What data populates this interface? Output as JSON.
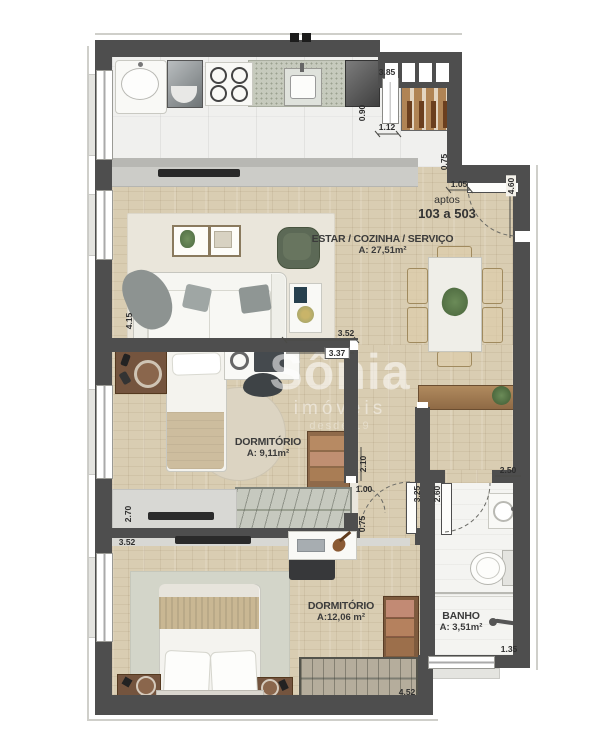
{
  "unit": {
    "prefix": "aptos",
    "range": "103 a 503"
  },
  "rooms": [
    {
      "name": "ESTAR / COZINHA / SERVIÇO",
      "area": "A: 27,51m²"
    },
    {
      "name": "DORMITÓRIO",
      "area": "A: 9,11m²"
    },
    {
      "name": "DORMITÓRIO",
      "area": "A:12,06 m²"
    },
    {
      "name": "BANHO",
      "area": "A: 3,51m²"
    }
  ],
  "watermark": {
    "brand": "Sônia",
    "sub": "imóveis",
    "tagline": "desde 19"
  },
  "colors": {
    "wall": "#4e4e4e",
    "wood_floor": "#d9cdb2",
    "tile_floor": "#f0f0ee",
    "accent_green": "#5c6956"
  },
  "dimensions": [
    {
      "v": "3.85",
      "x": 387,
      "y": 72,
      "rot": 0
    },
    {
      "v": "0.90",
      "x": 362,
      "y": 113,
      "rot": 1
    },
    {
      "v": "1.12",
      "x": 387,
      "y": 127,
      "rot": 0
    },
    {
      "v": "0.75",
      "x": 444,
      "y": 162,
      "rot": 1
    },
    {
      "v": "1.05",
      "x": 459,
      "y": 184,
      "rot": 0
    },
    {
      "v": "4.60",
      "x": 511,
      "y": 186,
      "rot": 1,
      "pill": 1
    },
    {
      "v": "4.15",
      "x": 129,
      "y": 321,
      "rot": 1
    },
    {
      "v": "3.52",
      "x": 346,
      "y": 333,
      "rot": 0
    },
    {
      "v": "3.37",
      "x": 337,
      "y": 353,
      "rot": 0,
      "box": 1
    },
    {
      "v": "2.10",
      "x": 363,
      "y": 464,
      "rot": 1
    },
    {
      "v": "1.00",
      "x": 364,
      "y": 489,
      "rot": 0
    },
    {
      "v": "0.75",
      "x": 362,
      "y": 524,
      "rot": 1
    },
    {
      "v": "2.70",
      "x": 128,
      "y": 514,
      "rot": 1
    },
    {
      "v": "3.52",
      "x": 127,
      "y": 542,
      "rot": 0
    },
    {
      "v": "3.25",
      "x": 417,
      "y": 494,
      "rot": 1
    },
    {
      "v": "2.60",
      "x": 437,
      "y": 494,
      "rot": 1
    },
    {
      "v": "2.50",
      "x": 508,
      "y": 470,
      "rot": 0
    },
    {
      "v": "1.35",
      "x": 509,
      "y": 649,
      "rot": 0
    },
    {
      "v": "4.52",
      "x": 407,
      "y": 692,
      "rot": 0
    }
  ]
}
